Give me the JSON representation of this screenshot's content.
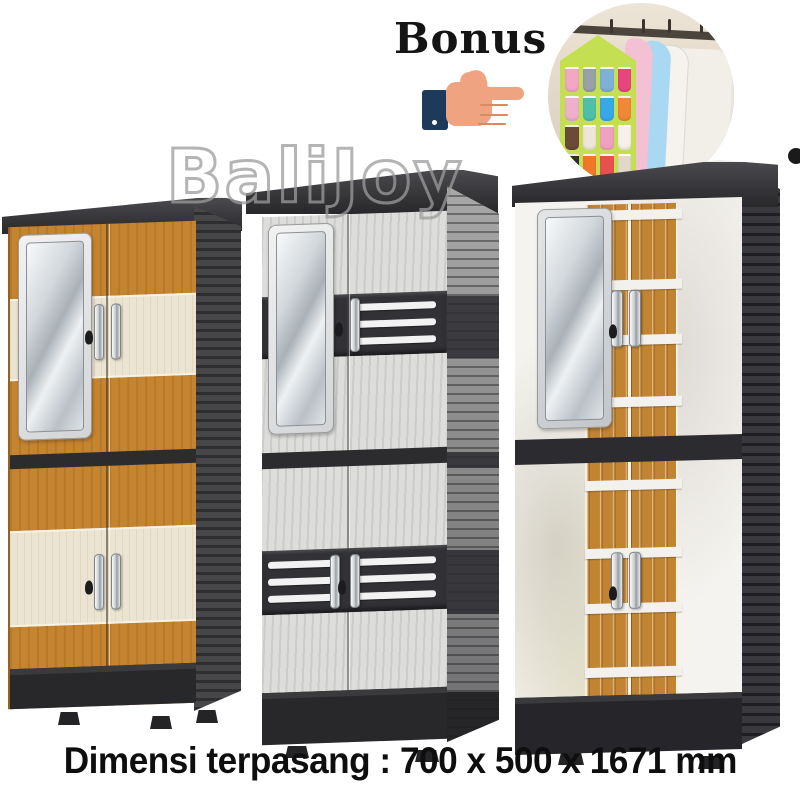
{
  "bonus": {
    "label": "Bonus"
  },
  "watermark": {
    "text": "BaliJoy"
  },
  "caption": {
    "text": "Dimensi terpasang : 700 x 500 x 1671 mm"
  },
  "dimensions_mm": {
    "width": 700,
    "depth": 500,
    "height": 1671
  },
  "icons": {
    "hand": "pointing-hand-icon",
    "dot": "corner-dot"
  },
  "colors": {
    "oak_wood": "#c5842f",
    "cream_band": "#ece4d2",
    "charcoal_frame": "#2c2c2f",
    "gray_door": "#dddddb",
    "gray_side": "#8e8e8e",
    "marble_door": "#f5f3ef",
    "hand_skin": "#f0a381",
    "hand_sleeve": "#1e3a5c",
    "corner_dot": "#1a1a1a"
  },
  "bonus_photo": {
    "items": [
      "hanging-pocket-organizer",
      "garment-covers"
    ],
    "organizer_color": "#c4df52",
    "rod_color": "#4a443c",
    "plant_color": "#7a9a5a",
    "pocket_colors": [
      "#f2a7c3",
      "#9aa0a8",
      "#7fb0d8",
      "#e8457f",
      "#eeb0cb",
      "#4fc0a8",
      "#38a8e8",
      "#f08838",
      "#6b4a3a",
      "#efe6db",
      "#f0a0c0",
      "#f5f0ea",
      "#2f2f2f",
      "#f07828",
      "#e85050",
      "#e0d8c8"
    ],
    "cover_colors": [
      "#f3c0d4",
      "#a8d8f2",
      "#f2efe8",
      "#eae6dd"
    ]
  },
  "cabinets": [
    {
      "id": "left",
      "finish": "oak with cream bands",
      "mirror": true,
      "doors": 4
    },
    {
      "id": "middle",
      "finish": "gray woodgrain with vent stripes",
      "mirror": true,
      "doors": 4
    },
    {
      "id": "right",
      "finish": "white marble with oak panels",
      "mirror": true,
      "doors": 4
    }
  ],
  "wood_separator_offsets": [
    6,
    76,
    131,
    193,
    276,
    344,
    399,
    463
  ]
}
